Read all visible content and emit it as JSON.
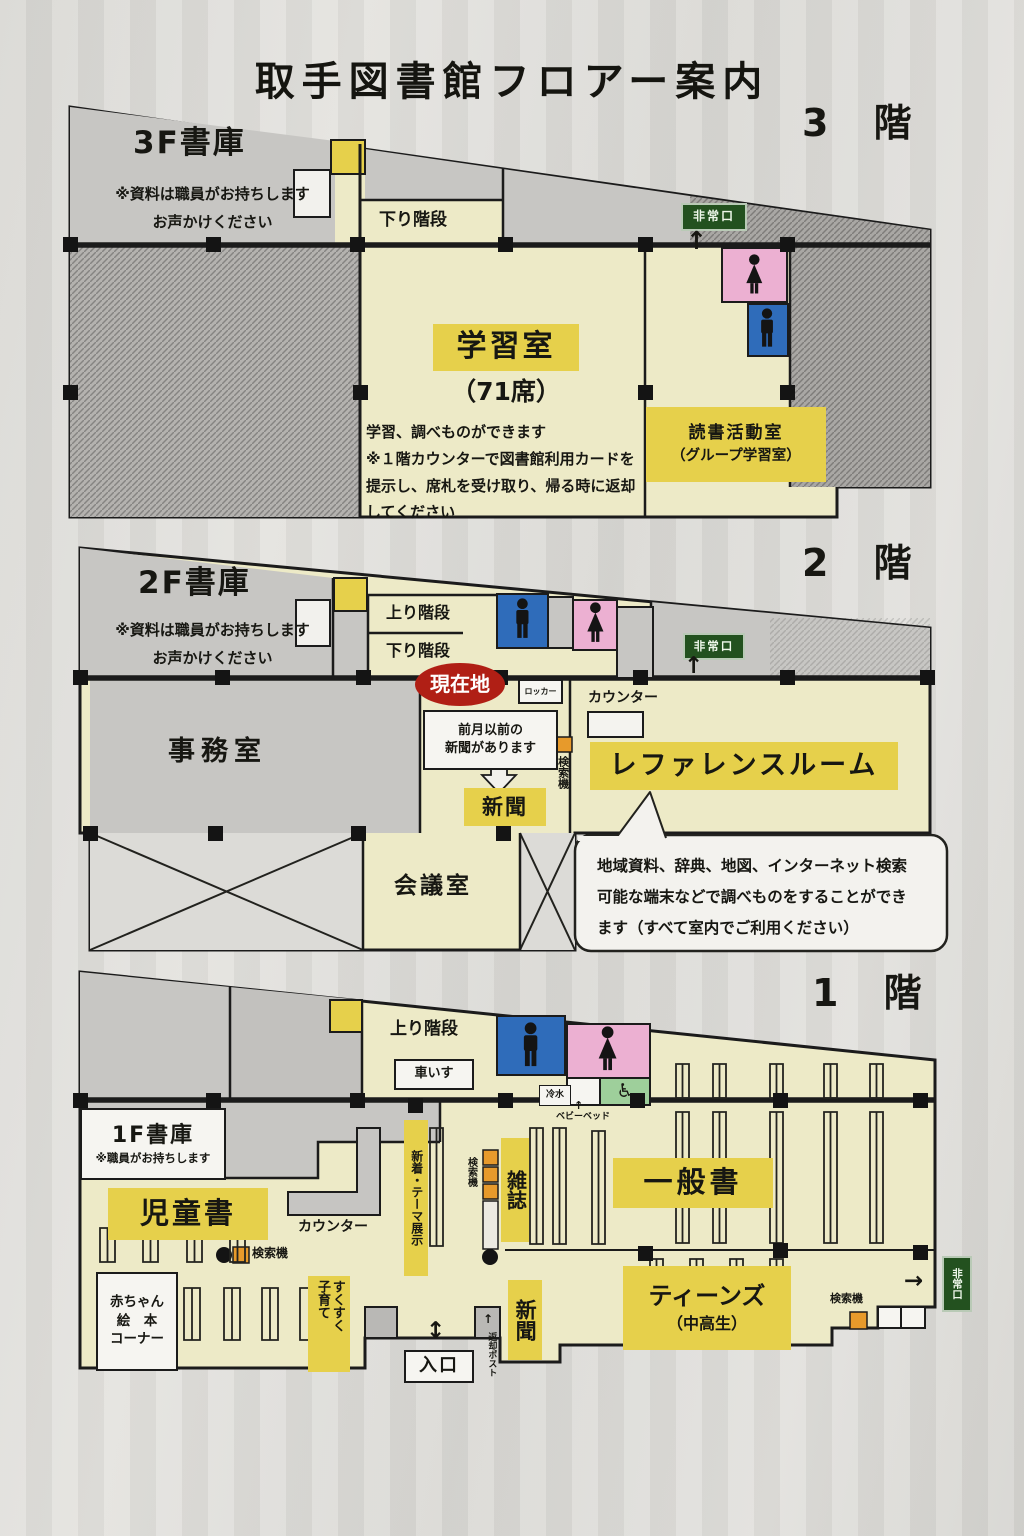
{
  "title": "取手図書館フロアー案内",
  "colors": {
    "highlight_yellow": "#e6d04b",
    "floor_cream": "#edeac7",
    "room_gray": "#c7c6c3",
    "hatch_gray": "#a9a7a4",
    "male_blue": "#2f6cba",
    "female_pink": "#ecb0d2",
    "accessible_green": "#9ecf9b",
    "search_orange": "#e79a2b",
    "here_red": "#b01f15",
    "exit_green": "#23511f"
  },
  "f3": {
    "floor_label": "3 階",
    "stack": "3F書庫",
    "stack_note1": "※資料は職員がお持ちします",
    "stack_note2": "お声かけください",
    "stairs_down": "下り階段",
    "study": "学習室",
    "study_seats": "（71席）",
    "study_note1": "学習、調べものができます",
    "study_note2": "※１階カウンターで図書館利用カードを",
    "study_note3": "提示し、席札を受け取り、帰る時に返却",
    "study_note4": "してください",
    "reading1": "読書活動室",
    "reading2": "（グループ学習室）",
    "exit": "非常口",
    "arrow_up": "↑"
  },
  "f2": {
    "floor_label": "2 階",
    "stack": "2F書庫",
    "stack_note1": "※資料は職員がお持ちします",
    "stack_note2": "お声かけください",
    "stairs_up": "上り階段",
    "stairs_down": "下り階段",
    "exit": "非常口",
    "arrow_up": "↑",
    "here": "現在地",
    "locker": "ロッカー",
    "counter": "カウンター",
    "office": "事務室",
    "news_note1": "前月以前の",
    "news_note2": "新聞があります",
    "newspaper": "新聞",
    "search": "検索機",
    "reference": "レファレンスルーム",
    "balloon1": "地域資料、辞典、地図、インターネット検索",
    "balloon2": "可能な端末などで調べものをすることができ",
    "balloon3": "ます（すべて室内でご利用ください）",
    "meeting": "会議室"
  },
  "f1": {
    "floor_label": "1 階",
    "stairs_up": "上り階段",
    "wheelchair": "車いす",
    "accessible_icon": "♿",
    "cold_water": "冷水",
    "baby_bed": "ベビーベッド",
    "stack": "1F書庫",
    "stack_note": "※職員がお持ちします",
    "children": "児童書",
    "counter": "カウンター",
    "search": "検索機",
    "new_theme": "新着・テーマ展示",
    "magazines": "雑誌",
    "newspaper": "新聞",
    "general": "一般書",
    "teens": "ティーンズ",
    "teens_sub": "（中高生）",
    "baby1": "赤ちゃん",
    "baby2": "絵　本",
    "baby3": "コーナー",
    "parenting1": "すくすく",
    "parenting2": "子育て",
    "entrance": "入口",
    "return_post": "返却ポスト",
    "exit": "非常口",
    "arrow_up": "↑",
    "arrow_ud": "↕",
    "arrow_right": "→"
  }
}
